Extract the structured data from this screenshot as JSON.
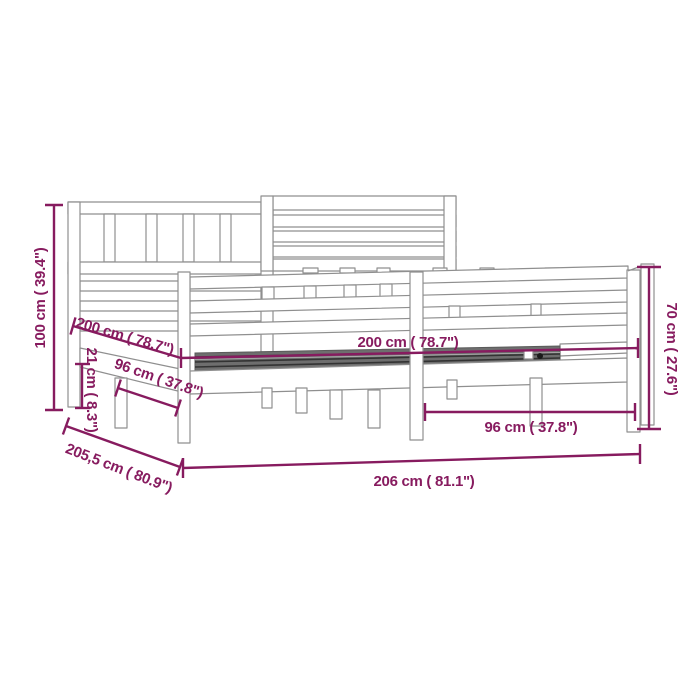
{
  "diagram": {
    "type": "product-dimension-diagram",
    "subject": "wooden bed frame with headboard",
    "accent_color": "#871B5F",
    "line_color": "#8F8F8F",
    "background_color": "#FFFFFF",
    "dimensions": [
      {
        "id": "headboard-height",
        "cm": "100",
        "inch": "39.4",
        "label": "100 cm ( 39.4\")"
      },
      {
        "id": "inner-length-side",
        "cm": "200",
        "inch": "78.7",
        "label": "200 cm ( 78.7\")"
      },
      {
        "id": "side-rail-height",
        "cm": "21",
        "inch": "8.3",
        "label": "21 cm ( 8.3\")"
      },
      {
        "id": "leg-spacing-side",
        "cm": "96",
        "inch": "37.8",
        "label": "96 cm ( 37.8\")"
      },
      {
        "id": "inner-length-front",
        "cm": "200",
        "inch": "78.7",
        "label": "200 cm ( 78.7\")"
      },
      {
        "id": "leg-spacing-front",
        "cm": "96",
        "inch": "37.8",
        "label": "96 cm ( 37.8\")"
      },
      {
        "id": "footboard-height",
        "cm": "70",
        "inch": "27.6",
        "label": "70 cm ( 27.6\")"
      },
      {
        "id": "overall-width",
        "cm": "206",
        "inch": "81.1",
        "label": "206 cm ( 81.1\")"
      },
      {
        "id": "overall-depth",
        "cm": "205,5",
        "inch": "80.9",
        "label": "205,5 cm ( 80.9\")"
      }
    ]
  }
}
